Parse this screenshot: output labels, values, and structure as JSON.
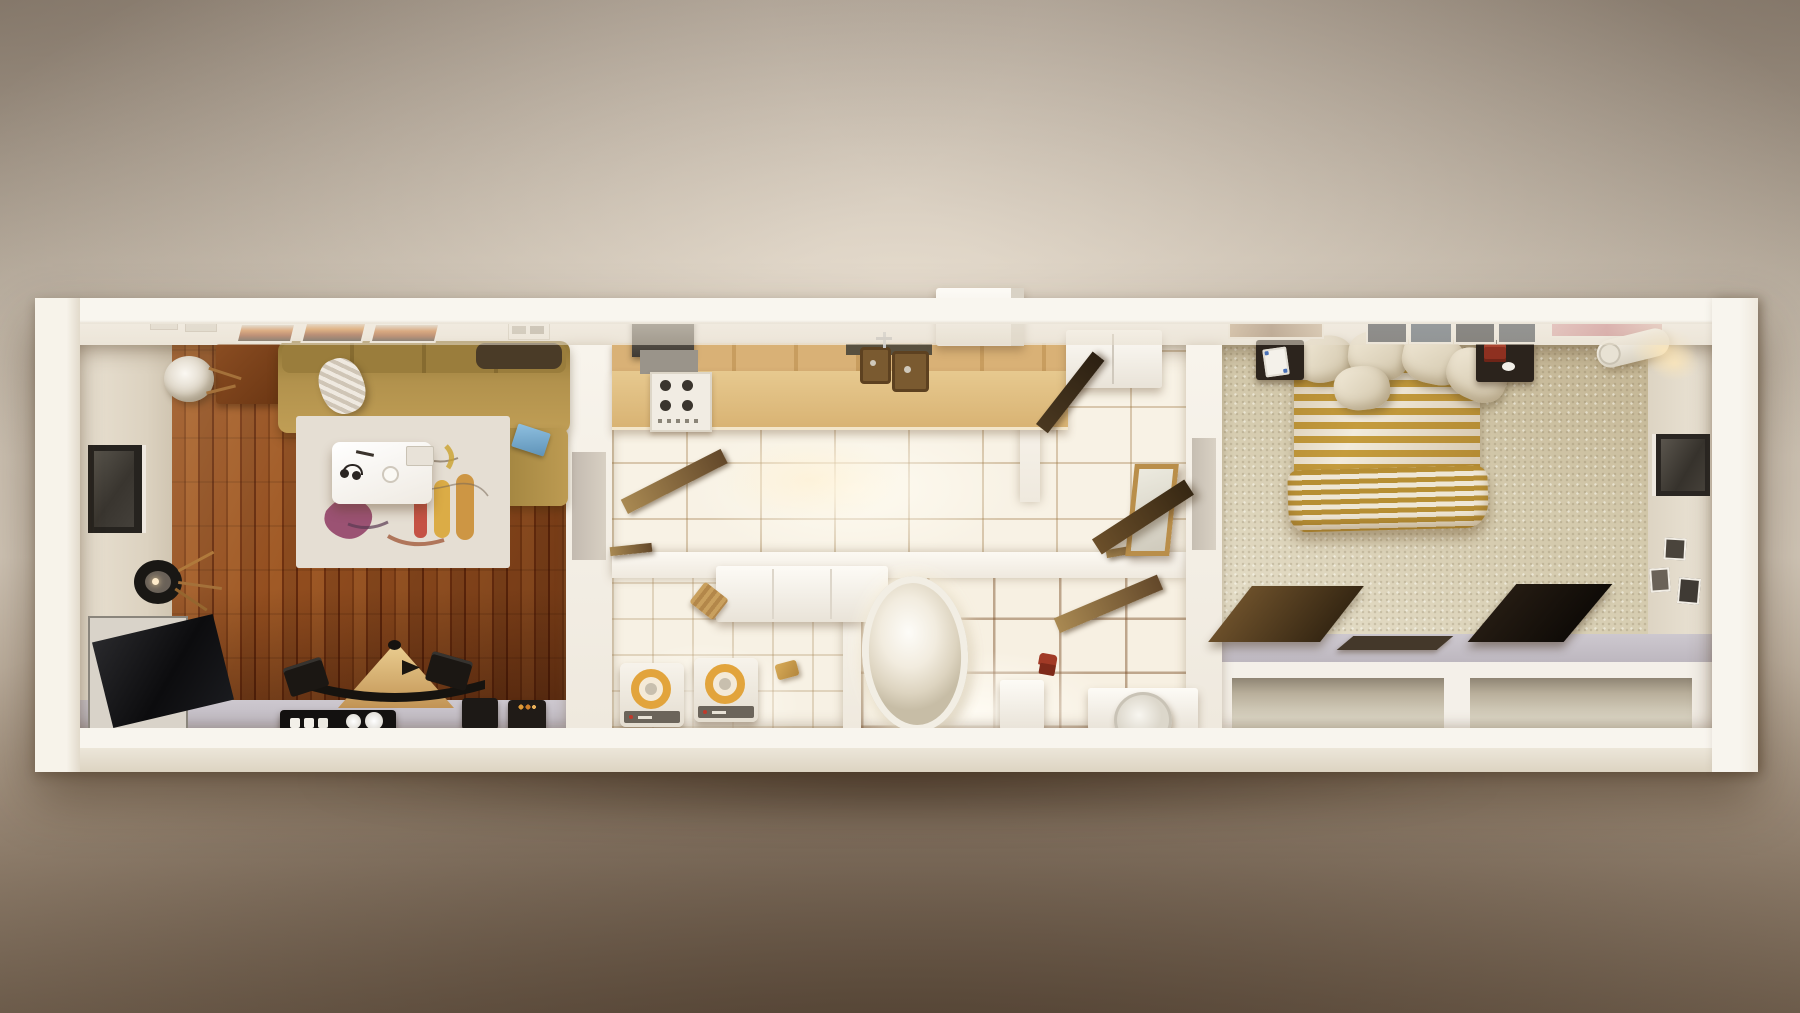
{
  "scene": {
    "title": "Top-down 3D cutaway render of a long one-bedroom apartment",
    "view": "dollhouse top view, photographic beige backdrop, no visible text",
    "palette": {
      "backdrop_light": "#d5cabb",
      "backdrop_dark": "#7d6c5a",
      "outer_wall": "#f5f0e8",
      "inner_wall_face": "#e4dccd",
      "wood_floor_dark": "#6f3110",
      "wood_floor_light": "#a05a26",
      "kitchen_tile": "#f8f2e5",
      "bath_grout": "#8a5f33",
      "counter_wood": "#d9b176",
      "sofa_tan": "#b2924d",
      "rug_base": "#ddd4c7",
      "carpet": "#d4caad",
      "duvet_gold": "#c59c3d",
      "duvet_cream": "#f2ebdc",
      "washer_lid_amber": "#e2a43c",
      "walkway_gray": "#c9c4cb",
      "leaning_panel": "#362713",
      "accent_red": "#a13a26"
    },
    "rooms": [
      {
        "name": "living room",
        "floor": "dark hardwood planks",
        "items": [
          "L-shaped tan fabric sofa",
          "dark bolster cushion",
          "knit throw pillow",
          "white egg chair",
          "wooden side cabinet",
          "abstract multicolor area rug",
          "white coffee table with headphones and cup",
          "black tripod floor lamp",
          "flat TV leaning against wall",
          "wooden pyramid speaker stand with black speakers",
          "black hi-fi console with white knobs",
          "two black storage cubes",
          "three orange abstract artworks on wall",
          "recessed window in left wall",
          "blue laptop on chaise"
        ]
      },
      {
        "name": "kitchen",
        "floor": "large cream ceramic tiles",
        "items": [
          "maple upper cabinets",
          "dark range hood",
          "white cooktop with four burners",
          "double-basin sink with faucet",
          "maple countertop",
          "white refrigerator",
          "tall white cabinet above wall line",
          "open wooden door to laundry",
          "open dark door to bedroom hall"
        ]
      },
      {
        "name": "laundry room",
        "floor": "small cream ceramic tiles",
        "items": [
          "two white washing machines with amber lids",
          "white wall cabinet",
          "woven laundry basket",
          "gold basket"
        ]
      },
      {
        "name": "bathroom",
        "floor": "large tiles with brown grout",
        "items": [
          "freestanding oval bathtub",
          "open wooden door",
          "red towel on floor",
          "white side cabinet",
          "white vanity",
          "round leaning mirror"
        ]
      },
      {
        "name": "bedroom",
        "floor": "beige speckled carpet",
        "items": [
          "double bed with mustard striped duvet",
          "scrunched striped blanket at foot",
          "five beige pillows",
          "dark left nightstand with white notepad",
          "dark right nightstand with red books",
          "row of dark framed prints above bed",
          "tan artwork",
          "pink artwork",
          "rolled white mattress in corner",
          "warm wall light glow",
          "leaning floor mirror",
          "three dark leaning wood panels",
          "flat panel on walkway",
          "recessed window in right wall",
          "three small picture frames",
          "two open closet niches"
        ]
      }
    ]
  }
}
